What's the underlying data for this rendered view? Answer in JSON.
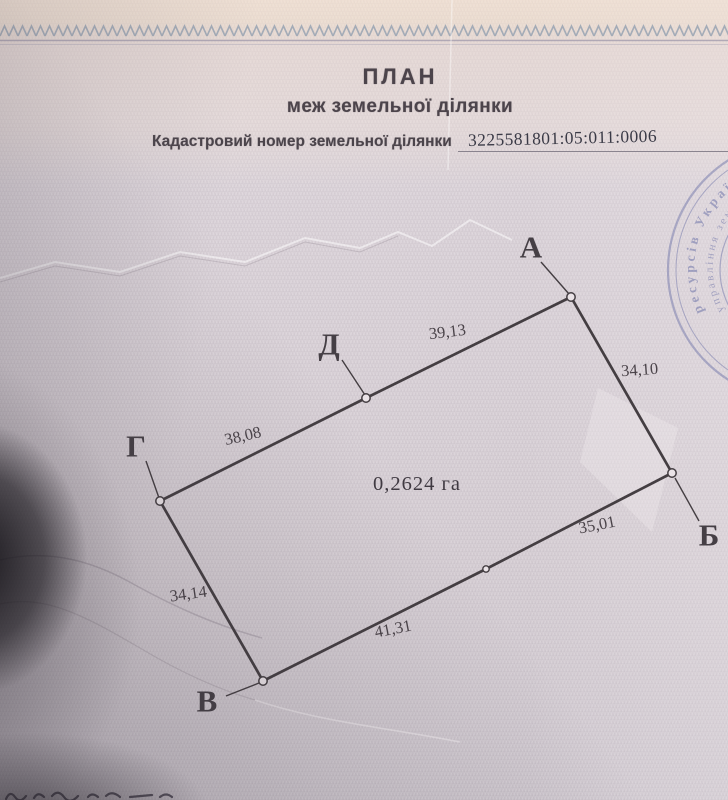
{
  "header": {
    "title": "ПЛАН",
    "subtitle": "меж земельної ділянки",
    "cadastral_label": "Кадастровий номер земельної ділянки",
    "cadastral_number": "3225581801:05:011:0006"
  },
  "plan": {
    "area_label": "0,2624 га",
    "area_x": 417,
    "area_y": 490,
    "polygon": [
      [
        571,
        297
      ],
      [
        672,
        473
      ],
      [
        486,
        569
      ],
      [
        263,
        681
      ],
      [
        160,
        501
      ],
      [
        366,
        398
      ]
    ],
    "extra_points": [
      [
        486,
        569
      ]
    ],
    "vertices": [
      {
        "name": "А",
        "id": "a",
        "x": 571,
        "y": 297,
        "label_x": 531,
        "label_y": 247,
        "leader": [
          541,
          262,
          569,
          294
        ]
      },
      {
        "name": "Б",
        "id": "b",
        "x": 672,
        "y": 473,
        "label_x": 709,
        "label_y": 535,
        "leader": [
          675,
          478,
          699,
          521
        ]
      },
      {
        "name": "В",
        "id": "v",
        "x": 263,
        "y": 681,
        "label_x": 207,
        "label_y": 701,
        "leader": [
          226,
          696,
          259,
          683
        ]
      },
      {
        "name": "Г",
        "id": "g",
        "x": 160,
        "y": 501,
        "label_x": 136,
        "label_y": 446,
        "leader": [
          146,
          461,
          159,
          498
        ]
      },
      {
        "name": "Д",
        "id": "d",
        "x": 366,
        "y": 398,
        "label_x": 329,
        "label_y": 344,
        "leader": [
          342,
          360,
          365,
          395
        ]
      }
    ],
    "side_labels": [
      {
        "text": "39,13",
        "x": 448,
        "y": 337,
        "rotate": -7
      },
      {
        "text": "34,10",
        "x": 640,
        "y": 375,
        "rotate": -4
      },
      {
        "text": "35,01",
        "x": 598,
        "y": 530,
        "rotate": -11
      },
      {
        "text": "41,31",
        "x": 394,
        "y": 634,
        "rotate": -11
      },
      {
        "text": "34,14",
        "x": 189,
        "y": 599,
        "rotate": -8
      },
      {
        "text": "38,08",
        "x": 244,
        "y": 441,
        "rotate": -13
      }
    ]
  },
  "stamp": {
    "outer_text": "ресурсів Украї",
    "middle_text": "управління зем",
    "inner_marks": "х  о"
  },
  "colors": {
    "paper": "#d8d0d6",
    "paper_top": "#ecdfd4",
    "band": "#93a0b0",
    "ink": "#453f45",
    "diagram_line": "#443e42",
    "side_label_ink": "#4a4349",
    "stamp_ink": "#5d64a0",
    "shadow": "#1c191f"
  }
}
